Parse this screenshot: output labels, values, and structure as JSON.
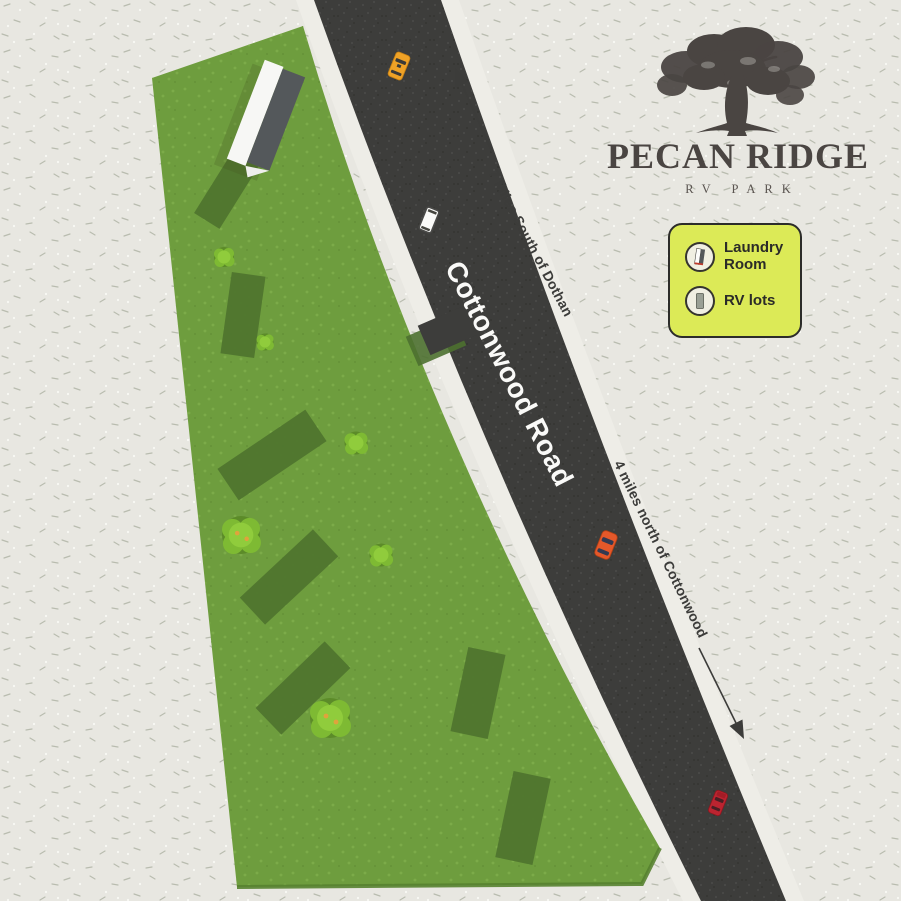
{
  "brand": {
    "name": "PECAN RIDGE",
    "tagline": "RV PARK"
  },
  "legend": {
    "items": [
      {
        "icon": "laundry-building-icon",
        "label": "Laundry Room"
      },
      {
        "icon": "rv-lot-icon",
        "label": "RV lots"
      }
    ]
  },
  "road": {
    "name": "Cottonwood Road",
    "direction_north": "7 Miles South of Dothan",
    "direction_south": "4 miles north of Cottonwood"
  },
  "map": {
    "rv_lot_count": 7,
    "bush_count": 6,
    "vehicle_colors": [
      "#efa226",
      "#fafaf8",
      "#e4582a",
      "#bb2430"
    ],
    "colors": {
      "background": "#e8e7e1",
      "grass": "#6e9d3e",
      "rv_lot": "#50752f",
      "road": "#3d3d3b",
      "legend_bg": "#dcea57",
      "logo": "#4a4542"
    }
  }
}
